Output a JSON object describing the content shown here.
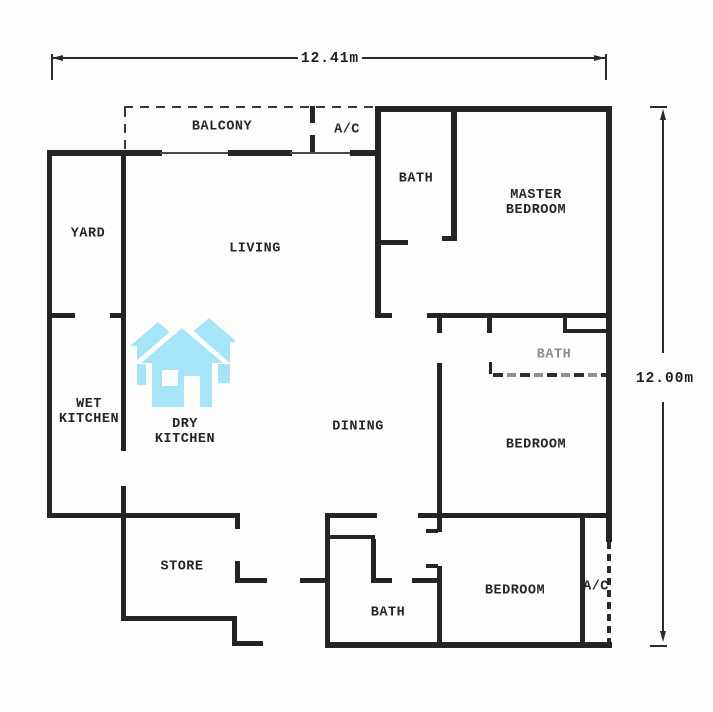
{
  "dimensions": {
    "width_label": "12.41m",
    "height_label": "12.00m"
  },
  "rooms": [
    {
      "id": "balcony",
      "label": "BALCONY",
      "x": 222,
      "y": 127
    },
    {
      "id": "ac-top",
      "label": "A/C",
      "x": 347,
      "y": 130
    },
    {
      "id": "bath-top",
      "label": "BATH",
      "x": 416,
      "y": 179
    },
    {
      "id": "master-bedroom",
      "label": "MASTER\nBEDROOM",
      "x": 536,
      "y": 203
    },
    {
      "id": "yard",
      "label": "YARD",
      "x": 88,
      "y": 234
    },
    {
      "id": "living",
      "label": "LIVING",
      "x": 255,
      "y": 249
    },
    {
      "id": "wet-kitchen",
      "label": "WET\nKITCHEN",
      "x": 89,
      "y": 412
    },
    {
      "id": "dry-kitchen",
      "label": "DRY\nKITCHEN",
      "x": 185,
      "y": 432
    },
    {
      "id": "dining",
      "label": "DINING",
      "x": 358,
      "y": 427
    },
    {
      "id": "bath-middle",
      "label": "BATH",
      "x": 554,
      "y": 355,
      "color": "#8d8d8d"
    },
    {
      "id": "bedroom-middle",
      "label": "BEDROOM",
      "x": 536,
      "y": 445
    },
    {
      "id": "store",
      "label": "STORE",
      "x": 182,
      "y": 567
    },
    {
      "id": "bath-bottom",
      "label": "BATH",
      "x": 388,
      "y": 613
    },
    {
      "id": "bedroom-bottom",
      "label": "BEDROOM",
      "x": 515,
      "y": 591
    },
    {
      "id": "ac-bottom",
      "label": "A/C",
      "x": 596,
      "y": 587
    }
  ],
  "logo": {
    "name": "three-houses-watermark",
    "color": "#a6e4f7"
  },
  "plan": {
    "wall_color": "#242424",
    "walls": [
      {
        "x": 375,
        "y": 106,
        "w": 237,
        "h": 6
      },
      {
        "x": 606,
        "y": 106,
        "w": 6,
        "h": 436
      },
      {
        "x": 607,
        "y": 542,
        "w": 4,
        "h": 104,
        "s": "dashwall-v"
      },
      {
        "x": 328,
        "y": 642,
        "w": 284,
        "h": 6
      },
      {
        "x": 47,
        "y": 150,
        "w": 5,
        "h": 365
      },
      {
        "x": 47,
        "y": 150,
        "w": 77,
        "h": 6
      },
      {
        "x": 124,
        "y": 150,
        "w": 38,
        "h": 6
      },
      {
        "x": 160,
        "y": 152,
        "w": 70,
        "h": 2,
        "s": "thin"
      },
      {
        "x": 228,
        "y": 150,
        "w": 64,
        "h": 6
      },
      {
        "x": 290,
        "y": 152,
        "w": 62,
        "h": 2,
        "s": "thin"
      },
      {
        "x": 350,
        "y": 150,
        "w": 30,
        "h": 6
      },
      {
        "x": 310,
        "y": 106,
        "w": 5,
        "h": 17
      },
      {
        "x": 310,
        "y": 135,
        "w": 5,
        "h": 17
      },
      {
        "x": 124,
        "y": 106,
        "w": 253,
        "h": 2,
        "s": "dash-h"
      },
      {
        "x": 124,
        "y": 108,
        "w": 2,
        "h": 44,
        "s": "dash-v"
      },
      {
        "x": 375,
        "y": 106,
        "w": 6,
        "h": 209
      },
      {
        "x": 377,
        "y": 240,
        "w": 31,
        "h": 5
      },
      {
        "x": 451,
        "y": 106,
        "w": 6,
        "h": 134
      },
      {
        "x": 442,
        "y": 236,
        "w": 15,
        "h": 5
      },
      {
        "x": 375,
        "y": 313,
        "w": 17,
        "h": 5
      },
      {
        "x": 427,
        "y": 313,
        "w": 185,
        "h": 5
      },
      {
        "x": 437,
        "y": 318,
        "w": 5,
        "h": 15
      },
      {
        "x": 487,
        "y": 318,
        "w": 5,
        "h": 15
      },
      {
        "x": 563,
        "y": 318,
        "w": 4,
        "h": 13
      },
      {
        "x": 563,
        "y": 329,
        "w": 45,
        "h": 4
      },
      {
        "x": 489,
        "y": 362,
        "w": 3,
        "h": 12
      },
      {
        "x": 493,
        "y": 373,
        "w": 114,
        "h": 4,
        "s": "dashgray-h"
      },
      {
        "x": 437,
        "y": 363,
        "w": 5,
        "h": 152
      },
      {
        "x": 437,
        "y": 518,
        "w": 5,
        "h": 14
      },
      {
        "x": 426,
        "y": 529,
        "w": 12,
        "h": 4
      },
      {
        "x": 426,
        "y": 564,
        "w": 12,
        "h": 4
      },
      {
        "x": 437,
        "y": 566,
        "w": 5,
        "h": 79
      },
      {
        "x": 418,
        "y": 513,
        "w": 194,
        "h": 5
      },
      {
        "x": 580,
        "y": 518,
        "w": 5,
        "h": 127
      },
      {
        "x": 47,
        "y": 313,
        "w": 28,
        "h": 5
      },
      {
        "x": 110,
        "y": 313,
        "w": 14,
        "h": 5
      },
      {
        "x": 121,
        "y": 150,
        "w": 5,
        "h": 301
      },
      {
        "x": 121,
        "y": 486,
        "w": 5,
        "h": 135
      },
      {
        "x": 47,
        "y": 513,
        "w": 193,
        "h": 5
      },
      {
        "x": 235,
        "y": 513,
        "w": 5,
        "h": 16
      },
      {
        "x": 235,
        "y": 561,
        "w": 5,
        "h": 22
      },
      {
        "x": 235,
        "y": 578,
        "w": 32,
        "h": 5
      },
      {
        "x": 300,
        "y": 578,
        "w": 27,
        "h": 5
      },
      {
        "x": 121,
        "y": 616,
        "w": 116,
        "h": 5
      },
      {
        "x": 232,
        "y": 621,
        "w": 5,
        "h": 25
      },
      {
        "x": 232,
        "y": 641,
        "w": 31,
        "h": 5
      },
      {
        "x": 325,
        "y": 513,
        "w": 5,
        "h": 135
      },
      {
        "x": 325,
        "y": 513,
        "w": 52,
        "h": 5
      },
      {
        "x": 328,
        "y": 535,
        "w": 47,
        "h": 4
      },
      {
        "x": 371,
        "y": 539,
        "w": 5,
        "h": 43
      },
      {
        "x": 371,
        "y": 578,
        "w": 21,
        "h": 5
      },
      {
        "x": 412,
        "y": 578,
        "w": 28,
        "h": 5
      }
    ]
  }
}
